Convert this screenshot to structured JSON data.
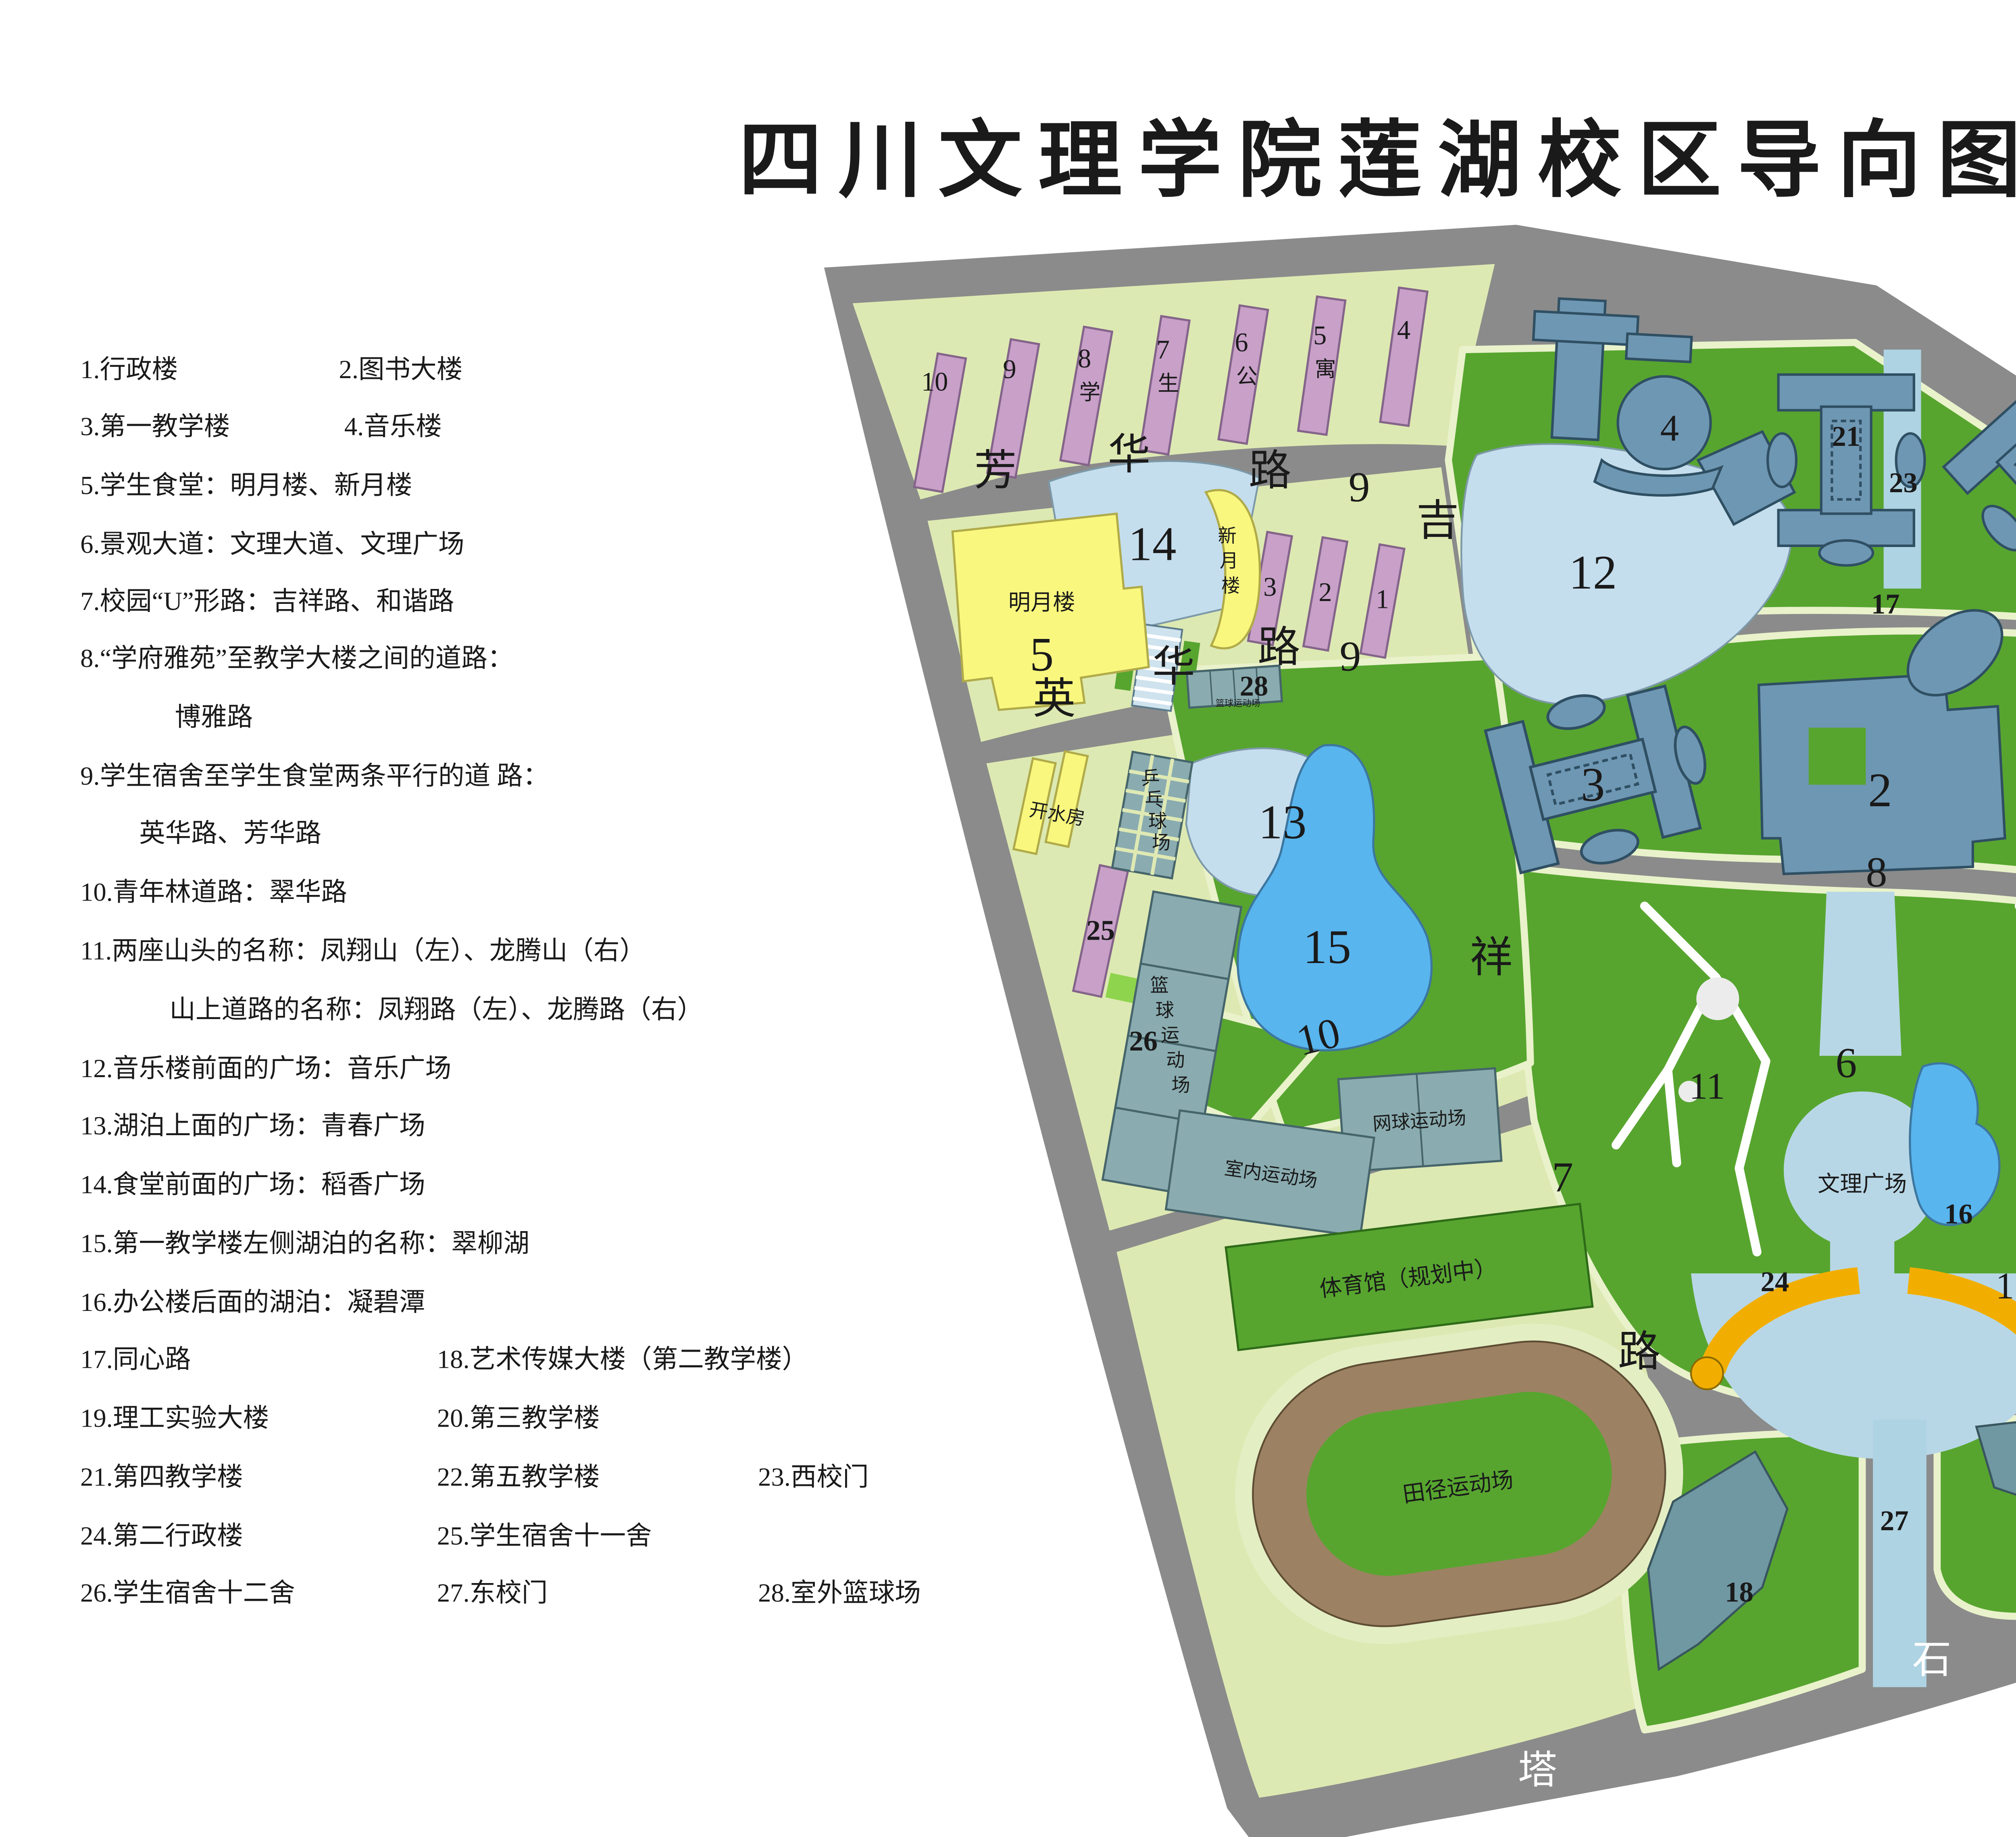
{
  "title": "四川文理学院莲湖校区导向图",
  "list_items": [
    "1.行政楼",
    "2.图书大楼",
    "3.第一教学楼",
    "4.音乐楼",
    "5.学生食堂：明月楼、新月楼",
    "6.景观大道：文理大道、文理广场",
    "7.校园“U”形路：吉祥路、和谐路",
    "8.“学府雅苑”至教学大楼之间的道路：",
    "博雅路",
    "9.学生宿舍至学生食堂两条平行的道 路：",
    "英华路、芳华路",
    "10.青年林道路：翠华路",
    "11.两座山头的名称：凤翔山（左）、龙腾山（右）",
    "山上道路的名称：凤翔路（左）、龙腾路（右）",
    "12.音乐楼前面的广场：音乐广场",
    "13.湖泊上面的广场：青春广场",
    "14.食堂前面的广场：稻香广场",
    "15.第一教学楼左侧湖泊的名称：翠柳湖",
    "16.办公楼后面的湖泊：凝碧潭",
    "17.同心路",
    "18.艺术传媒大楼（第二教学楼）",
    "19.理工实验大楼",
    "20.第三教学楼",
    "21.第四教学楼",
    "22.第五教学楼",
    "23.西校门",
    "24.第二行政楼",
    "25.学生宿舍十一舍",
    "26.学生宿舍十二舍",
    "27.东校门",
    "28.室外篮球场"
  ],
  "legend": {
    "items": [
      {
        "label": "学习区",
        "color": "#6e97b3"
      },
      {
        "label": "运动区",
        "color": "#85abae"
      },
      {
        "label": "办公区",
        "color": "#f2b000"
      },
      {
        "label": "生活区",
        "color": "#f9f77e"
      },
      {
        "label": "宿舍区",
        "color": "#c8a0c8"
      },
      {
        "label": "绿化区",
        "color": "#57a52f"
      }
    ]
  },
  "labels": {
    "fang": "芳",
    "hua_fang": "华",
    "lu_fang": "路",
    "nine_fang": "9",
    "ying": "英",
    "hua_ying": "华",
    "lu_ying": "路",
    "nine_ying": "9",
    "ji": "吉",
    "xiang": "祥",
    "lu_jixiang": "路",
    "seven_ji": "7",
    "he": "和",
    "xie": "谐",
    "lu_hexie": "路",
    "seven_he": "7",
    "ta": "塔",
    "shi": "石",
    "lu_tashi": "路",
    "n17": "17",
    "n8": "8",
    "n10": "10",
    "n6": "6",
    "d10": "10",
    "d9": "9",
    "d8": "8",
    "d7": "7",
    "d6": "6",
    "d5": "5",
    "d4": "4",
    "xue": "学",
    "sheng": "生",
    "gong": "公",
    "yu": "寓",
    "d3": "3",
    "d2": "2",
    "d1": "1",
    "mingyue": "明月楼",
    "b5": "5",
    "n14": "14",
    "xin": "新",
    "yue": "月",
    "lou": "楼",
    "kaishui": "开水房",
    "pp1": "乒",
    "pp2": "乓",
    "pp3": "球",
    "pp4": "场",
    "lq1": "篮",
    "lq2": "球",
    "lq3": "运",
    "lq4": "动",
    "lq5": "场",
    "n25": "25",
    "n26": "26",
    "n28": "28",
    "lq_small": "篮球运动场",
    "n13": "13",
    "n15": "15",
    "n16": "16",
    "wenli": "文理广场",
    "n12": "12",
    "b4": "4",
    "n21": "21",
    "n22": "22",
    "n23": "23",
    "b2": "2",
    "b3": "3",
    "n20": "20",
    "h11l": "11",
    "h11r": "11",
    "n24": "24",
    "b1": "1",
    "n18": "18",
    "n19": "19",
    "n27": "27",
    "wangqiu": "网球运动场",
    "shinei": "室内运动场",
    "tiyuguan": "体育馆（规划中）",
    "tianjing": "田径运动场",
    "xuefu": "学府雅苑"
  }
}
